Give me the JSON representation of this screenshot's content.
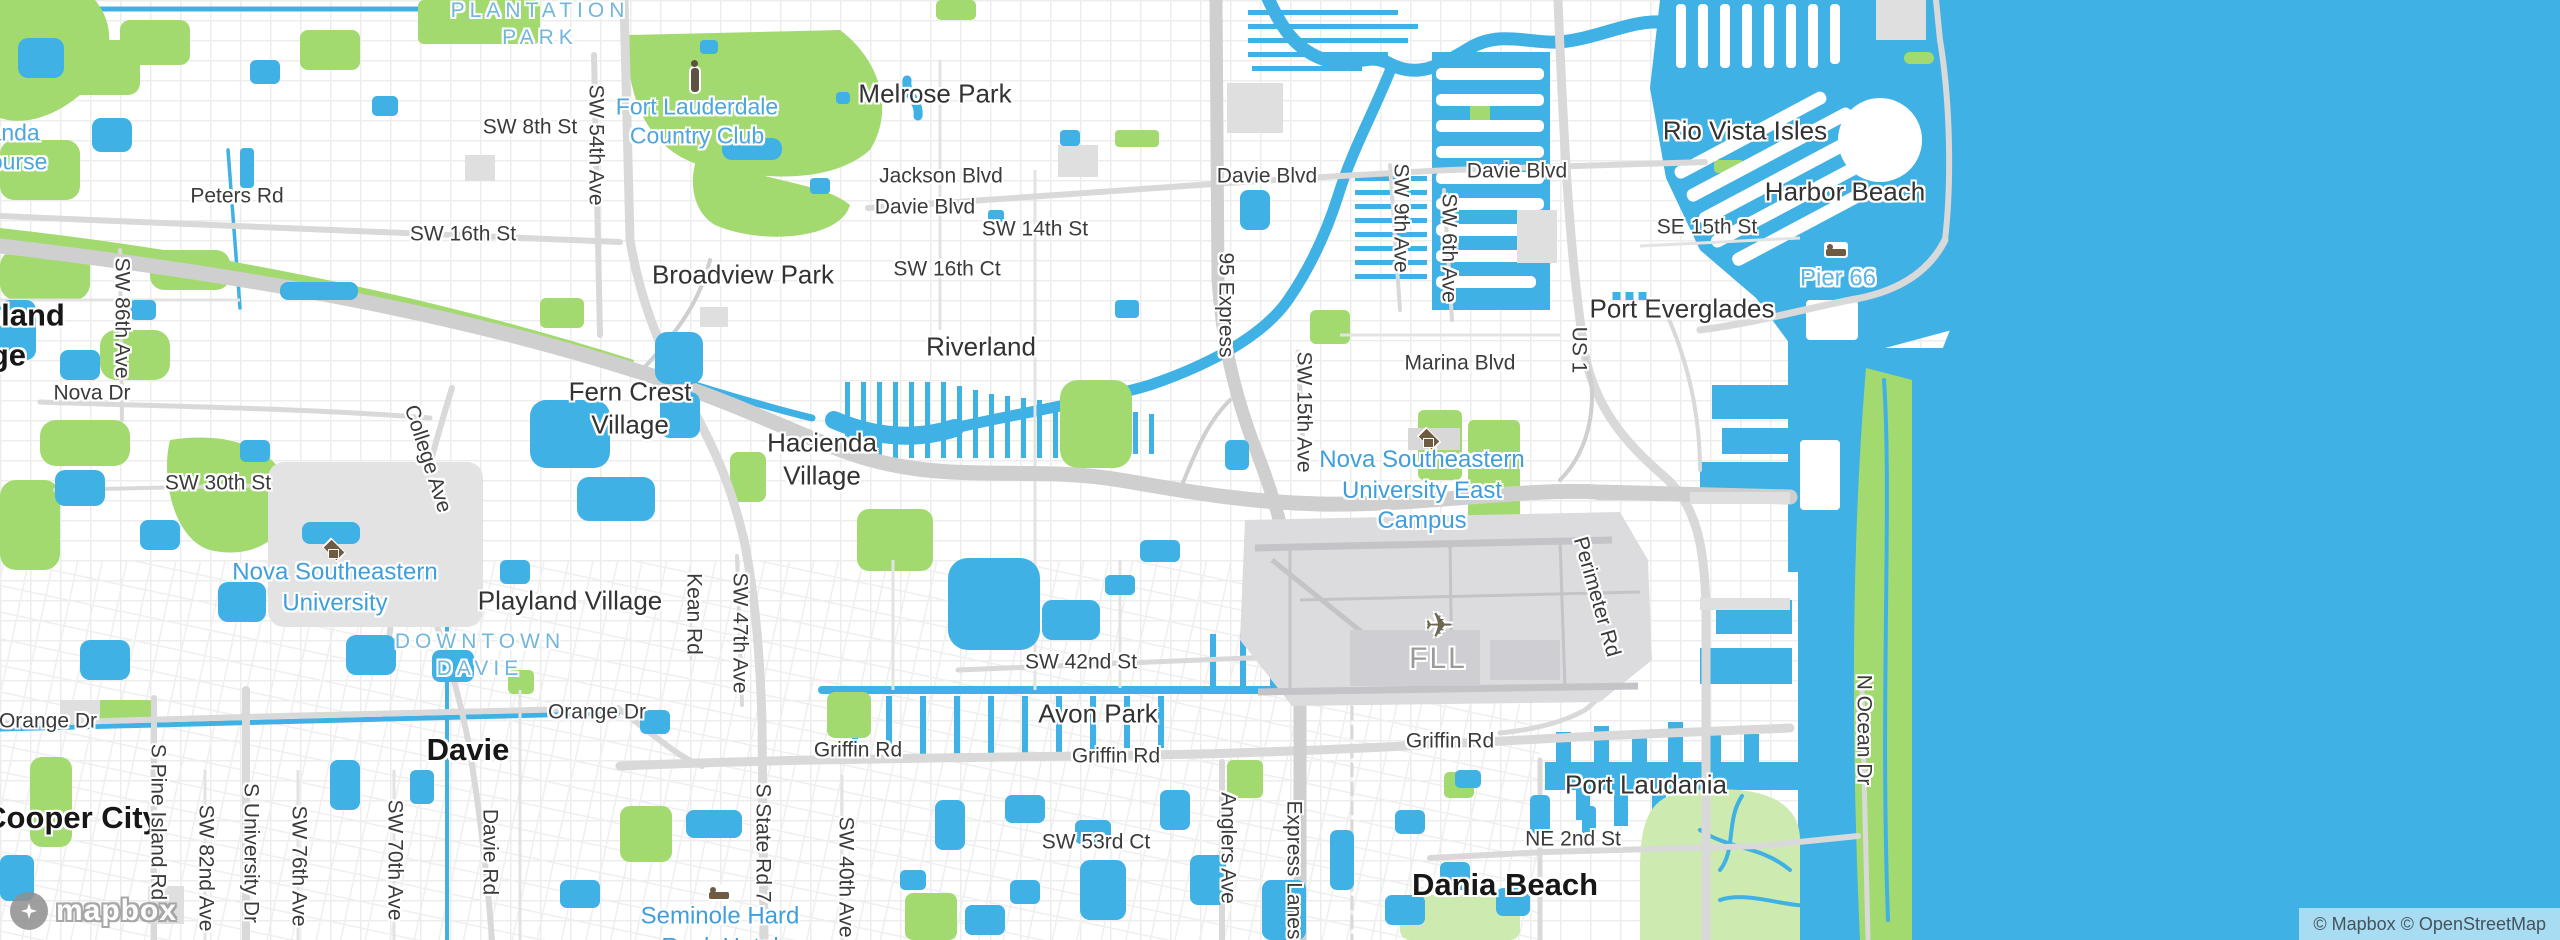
{
  "map": {
    "watermark": "mapbox",
    "attribution": "© Mapbox © OpenStreetMap",
    "colors": {
      "water": "#3fb1e4",
      "park_green": "#a3da70",
      "mangrove_green": "#cdeab0",
      "land": "#ffffff",
      "road_major": "#d2d2d2",
      "road_minor": "#e6e6e6",
      "building": "#dfdfdf",
      "airport": "#dcdcde",
      "label_city": "#171717",
      "label_road": "#3b3b3b",
      "label_poi_blue": "#3f9edc"
    },
    "labels": [
      {
        "t": "PLANTATION\nPARK",
        "x": 540,
        "y": 25,
        "cls": "cap"
      },
      {
        "t": "Jacaranda\nGolf Course",
        "x": -14,
        "y": 148,
        "cls": "golf"
      },
      {
        "t": "Fort Lauderdale\nCountry Club",
        "x": 697,
        "y": 122,
        "cls": "golf"
      },
      {
        "t": "Melrose Park",
        "x": 935,
        "y": 94,
        "cls": "hood"
      },
      {
        "t": "Rio Vista Isles",
        "x": 1745,
        "y": 131,
        "cls": "hood"
      },
      {
        "t": "Harbor Beach",
        "x": 1845,
        "y": 192,
        "cls": "hood"
      },
      {
        "t": "Port Everglades",
        "x": 1682,
        "y": 309,
        "cls": "hood"
      },
      {
        "t": "Riverland",
        "x": 981,
        "y": 347,
        "cls": "hood"
      },
      {
        "t": "Broadview Park",
        "x": 743,
        "y": 275,
        "cls": "hood"
      },
      {
        "t": "Fern Crest\nVillage",
        "x": 630,
        "y": 409,
        "cls": "hood"
      },
      {
        "t": "Hacienda\nVillage",
        "x": 822,
        "y": 460,
        "cls": "hood"
      },
      {
        "t": "Playland Village",
        "x": 570,
        "y": 601,
        "cls": "hood"
      },
      {
        "t": "Avon Park",
        "x": 1098,
        "y": 714,
        "cls": "hood"
      },
      {
        "t": "Port Laudania",
        "x": 1646,
        "y": 785,
        "cls": "hood"
      },
      {
        "t": "Davie",
        "x": 468,
        "y": 750,
        "cls": "city"
      },
      {
        "t": "Dania Beach",
        "x": 1505,
        "y": 885,
        "cls": "city"
      },
      {
        "t": "Cooper City",
        "x": 72,
        "y": 818,
        "cls": "city"
      },
      {
        "t": "Pine Island\nRidge",
        "x": -17,
        "y": 335,
        "cls": "city"
      },
      {
        "t": "SW 8th St",
        "x": 530,
        "y": 128,
        "cls": "road"
      },
      {
        "t": "SW 54th Ave",
        "x": 595,
        "y": 145,
        "cls": "road",
        "rot": 90
      },
      {
        "t": "Jackson Blvd",
        "x": 941,
        "y": 177,
        "cls": "road"
      },
      {
        "t": "Davie Blvd",
        "x": 925,
        "y": 208,
        "cls": "road"
      },
      {
        "t": "Davie Blvd",
        "x": 1267,
        "y": 177,
        "cls": "road"
      },
      {
        "t": "Davie Blvd",
        "x": 1517,
        "y": 172,
        "cls": "road"
      },
      {
        "t": "SW 14th St",
        "x": 1035,
        "y": 230,
        "cls": "road"
      },
      {
        "t": "SW 16th Ct",
        "x": 947,
        "y": 270,
        "cls": "road"
      },
      {
        "t": "SW 16th St",
        "x": 463,
        "y": 235,
        "cls": "road"
      },
      {
        "t": "Peters Rd",
        "x": 237,
        "y": 197,
        "cls": "road"
      },
      {
        "t": "SW 9th Ave",
        "x": 1400,
        "y": 218,
        "cls": "road",
        "rot": 90
      },
      {
        "t": "SW 6th Ave",
        "x": 1448,
        "y": 248,
        "cls": "road",
        "rot": 90
      },
      {
        "t": "95 Express",
        "x": 1225,
        "y": 305,
        "cls": "road",
        "rot": 90
      },
      {
        "t": "SE 15th St",
        "x": 1707,
        "y": 228,
        "cls": "road"
      },
      {
        "t": "US 1",
        "x": 1578,
        "y": 350,
        "cls": "road",
        "rot": 90
      },
      {
        "t": "Marina Blvd",
        "x": 1460,
        "y": 364,
        "cls": "road"
      },
      {
        "t": "SW 15th Ave",
        "x": 1303,
        "y": 412,
        "cls": "road",
        "rot": 90
      },
      {
        "t": "SW 86th Ave",
        "x": 121,
        "y": 318,
        "cls": "road",
        "rot": 90
      },
      {
        "t": "Nova Dr",
        "x": 92,
        "y": 394,
        "cls": "road"
      },
      {
        "t": "SW 30th St",
        "x": 218,
        "y": 484,
        "cls": "road"
      },
      {
        "t": "College Ave",
        "x": 427,
        "y": 459,
        "cls": "road",
        "rot": 72
      },
      {
        "t": "Kean Rd",
        "x": 693,
        "y": 614,
        "cls": "road",
        "rot": 90
      },
      {
        "t": "SW 47th Ave",
        "x": 739,
        "y": 633,
        "cls": "road",
        "rot": 90
      },
      {
        "t": "SW 42nd St",
        "x": 1081,
        "y": 663,
        "cls": "road"
      },
      {
        "t": "Perimeter Rd",
        "x": 1596,
        "y": 597,
        "cls": "road",
        "rot": 74
      },
      {
        "t": "Orange Dr",
        "x": 48,
        "y": 722,
        "cls": "road"
      },
      {
        "t": "Orange Dr",
        "x": 597,
        "y": 713,
        "cls": "road"
      },
      {
        "t": "Griffin Rd",
        "x": 858,
        "y": 751,
        "cls": "road"
      },
      {
        "t": "Griffin Rd",
        "x": 1116,
        "y": 757,
        "cls": "road"
      },
      {
        "t": "Griffin Rd",
        "x": 1450,
        "y": 742,
        "cls": "road"
      },
      {
        "t": "S Pine Island Rd",
        "x": 157,
        "y": 822,
        "cls": "road",
        "rot": 90
      },
      {
        "t": "SW 82nd Ave",
        "x": 205,
        "y": 868,
        "cls": "road",
        "rot": 90
      },
      {
        "t": "S University Dr",
        "x": 250,
        "y": 853,
        "cls": "road",
        "rot": 90
      },
      {
        "t": "SW 76th Ave",
        "x": 298,
        "y": 866,
        "cls": "road",
        "rot": 90
      },
      {
        "t": "SW 70th Ave",
        "x": 394,
        "y": 860,
        "cls": "road",
        "rot": 90
      },
      {
        "t": "Davie Rd",
        "x": 489,
        "y": 852,
        "cls": "road",
        "rot": 90
      },
      {
        "t": "S State Rd 7",
        "x": 762,
        "y": 843,
        "cls": "road",
        "rot": 90
      },
      {
        "t": "SW 40th Ave",
        "x": 845,
        "y": 877,
        "cls": "road",
        "rot": 90
      },
      {
        "t": "SW 53rd Ct",
        "x": 1096,
        "y": 843,
        "cls": "road"
      },
      {
        "t": "Anglers Ave",
        "x": 1227,
        "y": 848,
        "cls": "road",
        "rot": 90
      },
      {
        "t": "Express Lanes",
        "x": 1293,
        "y": 870,
        "cls": "road",
        "rot": 90
      },
      {
        "t": "NE 2nd St",
        "x": 1573,
        "y": 840,
        "cls": "road"
      },
      {
        "t": "N Ocean Dr",
        "x": 1863,
        "y": 730,
        "cls": "road",
        "rot": 90
      },
      {
        "t": "Pier 66",
        "x": 1838,
        "y": 279,
        "cls": "water"
      },
      {
        "t": "Nova Southeastern\nUniversity East\nCampus",
        "x": 1422,
        "y": 491,
        "cls": "poi"
      },
      {
        "t": "Nova Southeastern\nUniversity",
        "x": 335,
        "y": 588,
        "cls": "poi"
      },
      {
        "t": "Seminole Hard\nRock Hotel",
        "x": 720,
        "y": 932,
        "cls": "poi"
      },
      {
        "t": "DOWNTOWN\nDAVIE",
        "x": 480,
        "y": 656,
        "cls": "cap"
      },
      {
        "t": "FLL",
        "x": 1438,
        "y": 659,
        "cls": "gray"
      }
    ],
    "icons": [
      {
        "type": "golfer-icon",
        "x": 695,
        "y": 80
      },
      {
        "type": "bed-icon",
        "x": 1836,
        "y": 250
      },
      {
        "type": "bed-icon",
        "x": 719,
        "y": 893
      },
      {
        "type": "grad-cap-icon",
        "x": 1428,
        "y": 437
      },
      {
        "type": "grad-cap-icon",
        "x": 333,
        "y": 548
      },
      {
        "type": "plane-icon",
        "x": 1439,
        "y": 626,
        "glyph": "✈"
      },
      {
        "type": "harbor-poi-icons",
        "x": 1632,
        "y": 296
      }
    ]
  }
}
